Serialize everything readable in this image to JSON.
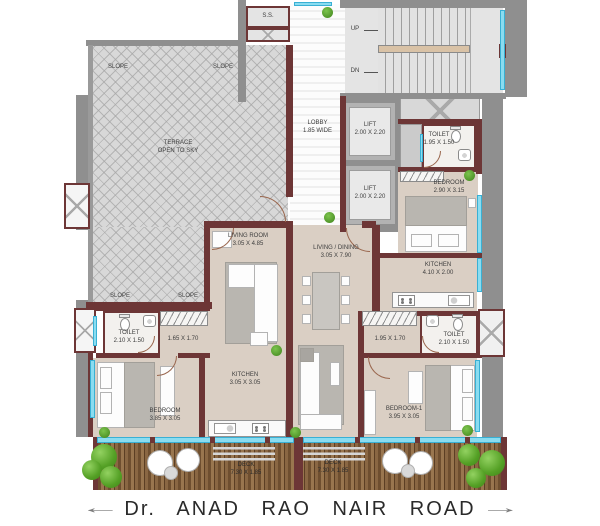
{
  "colors": {
    "wall_brown": "#6d3636",
    "wall_gray": "#8f8f8f",
    "window_cyan": "#8adcf0",
    "floor_beige": "#dacfc4",
    "deck_wood": "#7a5a3a",
    "tree_green": "#54a025"
  },
  "road": {
    "name": "Dr. ANAD  RAO  NAIR  ROAD",
    "arrow_left": "←",
    "arrow_right": "→"
  },
  "terrace": {
    "name": "TERRACE",
    "sub": "OPEN TO SKY",
    "slope": "SLOPE"
  },
  "core": {
    "ss": "S.S.",
    "up": "UP",
    "dn": "DN",
    "lobby_name": "LOBBY",
    "lobby_dim": "1.85 WIDE",
    "lift_name": "LIFT",
    "lift_dim": "2.00 X 2.20"
  },
  "unit_top": {
    "toilet_name": "TOILET",
    "toilet_dim": "1.95 X 1.50",
    "bedroom_name": "BEDROOM",
    "bedroom_dim": "2.90 X 3.15"
  },
  "unit_left": {
    "living_name": "LIVING ROOM",
    "living_dim": "3.05 X 4.85",
    "toilet_name": "TOILET",
    "toilet_dim": "2.10 X 1.50",
    "passage_dim": "1.65 X 1.70",
    "kitchen_name": "KITCHEN",
    "kitchen_dim": "3.05 X 3.05",
    "bedroom_name": "BEDROOM",
    "bedroom_dim": "3.85 X 3.05",
    "deck_name": "DECK",
    "deck_dim": "7.30 X 1.85"
  },
  "unit_right": {
    "living_name": "LIVING / DINING",
    "living_dim": "3.05 X 7.90",
    "kitchen_name": "KITCHEN",
    "kitchen_dim": "4.10 X 2.00",
    "passage_dim": "1.95 X 1.70",
    "toilet_name": "TOILET",
    "toilet_dim": "2.10 X 1.50",
    "bedroom_name": "BEDROOM-1",
    "bedroom_dim": "3.95 X 3.05",
    "deck_name": "DECK",
    "deck_dim": "7.30 X 1.85"
  }
}
